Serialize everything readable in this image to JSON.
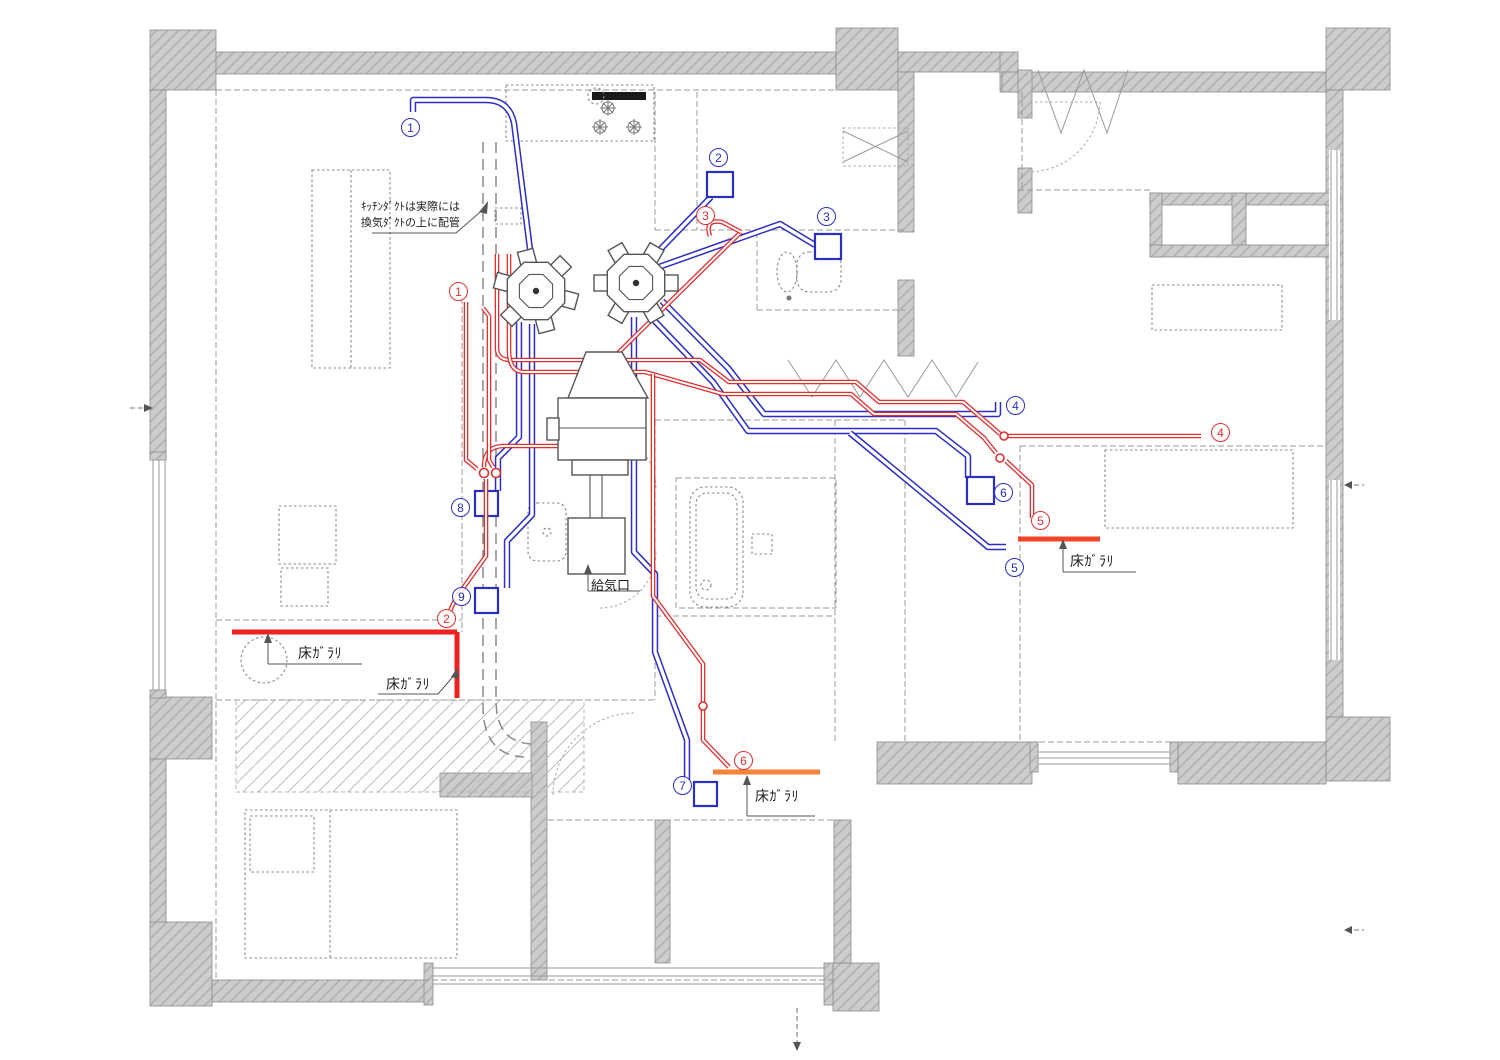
{
  "drawing": {
    "type": "floor-plan-duct-routing",
    "colors": {
      "duct_blue": "#2a2ec4",
      "duct_red": "#e03030",
      "grille_red": "#ee2222",
      "grille_orange": "#f58238",
      "wall_fill": "#cccccc",
      "wall_hatch": "#b0b0b0",
      "line_gray": "#9a9a9a",
      "dark": "#444444"
    }
  },
  "annotations": {
    "kitchen_duct_note_line1": "ｷｯﾁﾝﾀﾞｸﾄは実際には",
    "kitchen_duct_note_line2": "換気ﾀﾞｸﾄの上に配管",
    "floor_grille": "床ｶﾞﾗﾘ",
    "supply_air": "給気口"
  },
  "markers": {
    "blue": [
      "1",
      "2",
      "3",
      "4",
      "5",
      "6",
      "7",
      "8",
      "9"
    ],
    "red": [
      "1",
      "2",
      "3",
      "4",
      "5",
      "6"
    ]
  }
}
